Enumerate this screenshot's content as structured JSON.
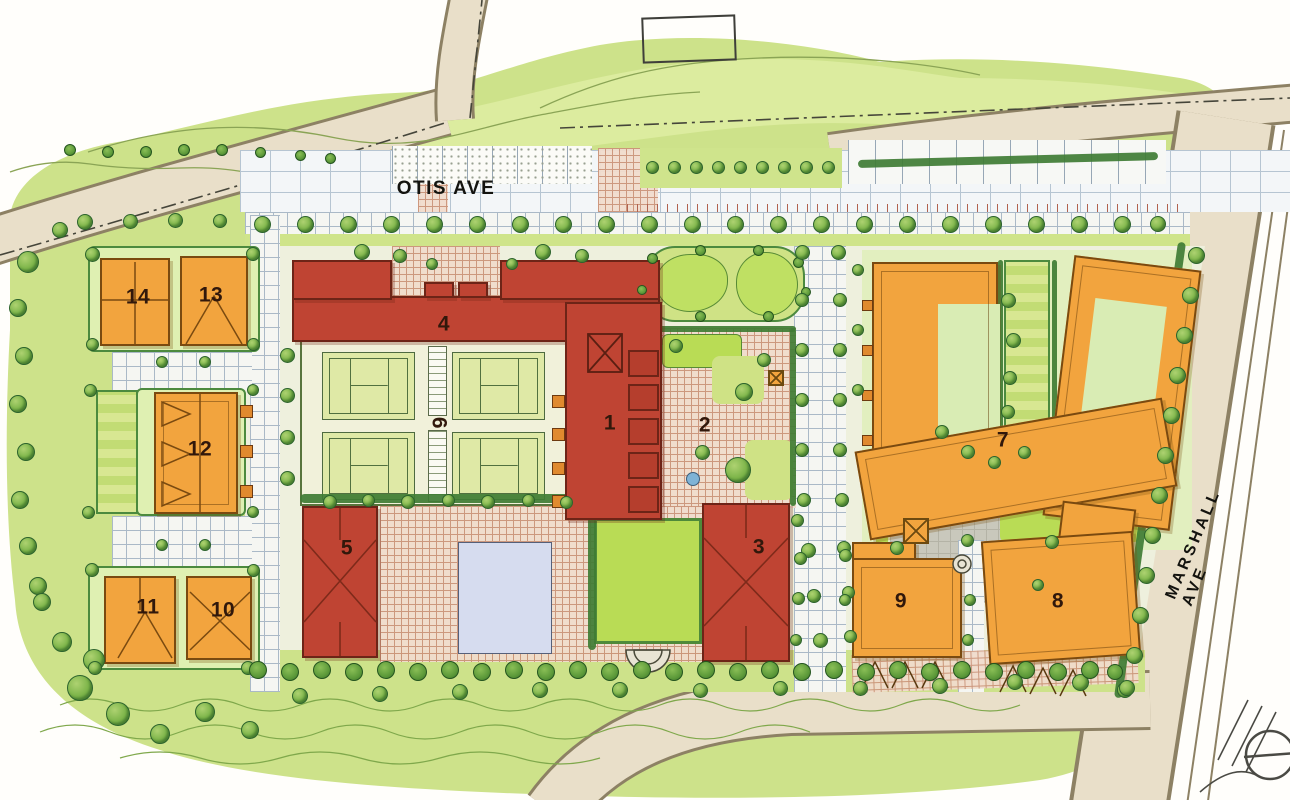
{
  "title": "Residential neighborhood illustrative site plan",
  "streets": {
    "otis": "OTIS AVE",
    "marshall": "MARSHALL AVE"
  },
  "buildings": [
    {
      "label": "1"
    },
    {
      "label": "2"
    },
    {
      "label": "3"
    },
    {
      "label": "4"
    },
    {
      "label": "5"
    },
    {
      "label": "6"
    },
    {
      "label": "7"
    },
    {
      "label": "8"
    },
    {
      "label": "9"
    },
    {
      "label": "10"
    },
    {
      "label": "11"
    },
    {
      "label": "12"
    },
    {
      "label": "13"
    },
    {
      "label": "14"
    }
  ],
  "colors": {
    "building_red": "#bf4433",
    "building_orange": "#f2a43e",
    "lawn_green": "#b9dc55",
    "wash_green": "#cde28a",
    "hedge_green": "#3f7c34",
    "tree_green": "#7cb449",
    "paving_pink": "#f1dccd",
    "paving_line": "#cb9479",
    "road_beige": "#e9dfc9",
    "pool_blue": "#d6dcef",
    "court_green": "#dfe9a6",
    "grid_blue": "#b6c5d2"
  }
}
